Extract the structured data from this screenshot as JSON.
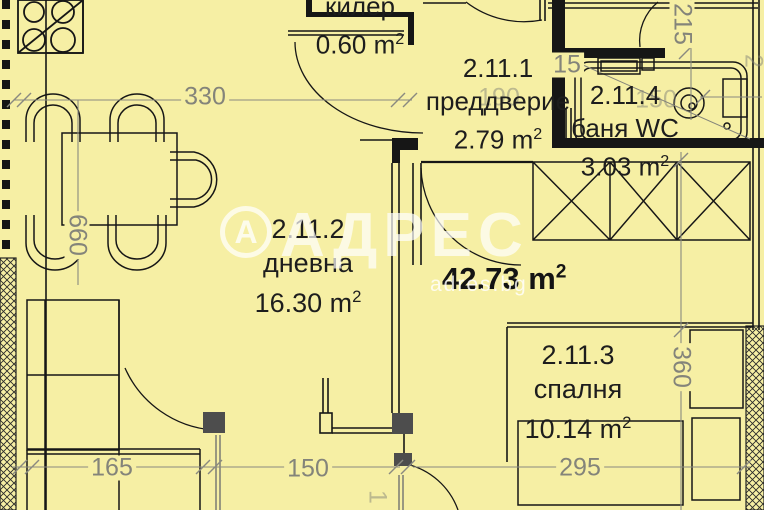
{
  "watermark": {
    "logo_letter": "А",
    "brand": "АДРЕС",
    "site": "adres.bg"
  },
  "total_area": "42.73 m",
  "sup2": "2",
  "rooms": {
    "kiler": {
      "code": "",
      "name": "килер",
      "area": "0.60 m"
    },
    "hall": {
      "code": "2.11.1",
      "name": "преддверие",
      "area": "2.79 m"
    },
    "bath": {
      "code": "2.11.4",
      "name": "баня WC",
      "area": "3.03 m"
    },
    "living": {
      "code": "2.11.2",
      "name": "дневна",
      "area": "16.30 m"
    },
    "bedroom": {
      "code": "2.11.3",
      "name": "спалня",
      "area": "10.14 m"
    }
  },
  "dimensions": {
    "width_living_top": "330",
    "height_living_left": "660",
    "height_top_right": "215",
    "width_hall_faint": "190",
    "width_hall_small": "15",
    "width_bath_faint": "150",
    "width_sofa": "165",
    "width_living_bottom": "150",
    "width_bedroom": "295",
    "height_bedroom": "360",
    "edge_right": "2",
    "edge_bottom": "1"
  },
  "colors": {
    "background": "#f6efa4",
    "wall": "#161616",
    "dimension": "#84847a",
    "column": "#4d4d4d",
    "watermark": "#ffffff"
  }
}
